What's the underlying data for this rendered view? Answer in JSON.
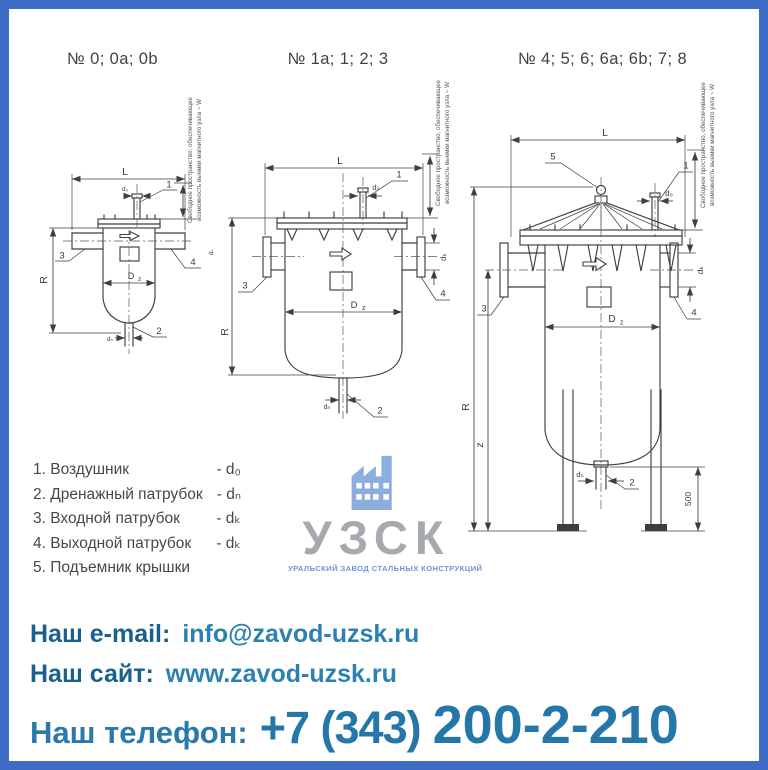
{
  "frame": {
    "border_color": "#3d6cc4",
    "background": "#ffffff"
  },
  "titles": {
    "d1": "№ 0; 0a; 0b",
    "d2": "№ 1a; 1; 2; 3",
    "d3": "№ 4; 5; 6; 6a; 6b; 7; 8"
  },
  "note": {
    "line1": "Свободное пространство, обеспечивающее",
    "line2": "возможность выемки магнитного узла ~ W"
  },
  "dims": {
    "L": "L",
    "R": "R",
    "D": "D",
    "z_sub": "z",
    "z": "z",
    "d0": "d₀",
    "dn": "dₙ",
    "dk": "dₖ",
    "h500": "500"
  },
  "callouts": {
    "c1": "1",
    "c2": "2",
    "c3": "3",
    "c4": "4",
    "c5": "5"
  },
  "legend": {
    "items": [
      {
        "text": "1. Воздушник",
        "dim": "- d₀"
      },
      {
        "text": "2. Дренажный патрубок",
        "dim": "- dₙ"
      },
      {
        "text": "3. Входной патрубок",
        "dim": "- dₖ"
      },
      {
        "text": "4. Выходной патрубок",
        "dim": "- dₖ"
      },
      {
        "text": "5. Подъемник крышки",
        "dim": ""
      }
    ]
  },
  "logo": {
    "name": "УЗСК",
    "tagline": "УРАЛЬСКИЙ ЗАВОД СТАЛЬНЫХ КОНСТРУКЦИЙ",
    "icon_color": "#8cade0",
    "name_color": "#a6a9ad",
    "tagline_color": "#6e93d8"
  },
  "contacts": {
    "email_label": "Наш e-mail:",
    "email_value": "info@zavod-uzsk.ru",
    "site_label": "Наш сайт:",
    "site_value": "www.zavod-uzsk.ru",
    "phone_label": "Наш телефон:",
    "phone_prefix": "+7 (343)",
    "phone_number": "200-2-210",
    "label_color": "#19608d",
    "value_color": "#2d81b1"
  }
}
